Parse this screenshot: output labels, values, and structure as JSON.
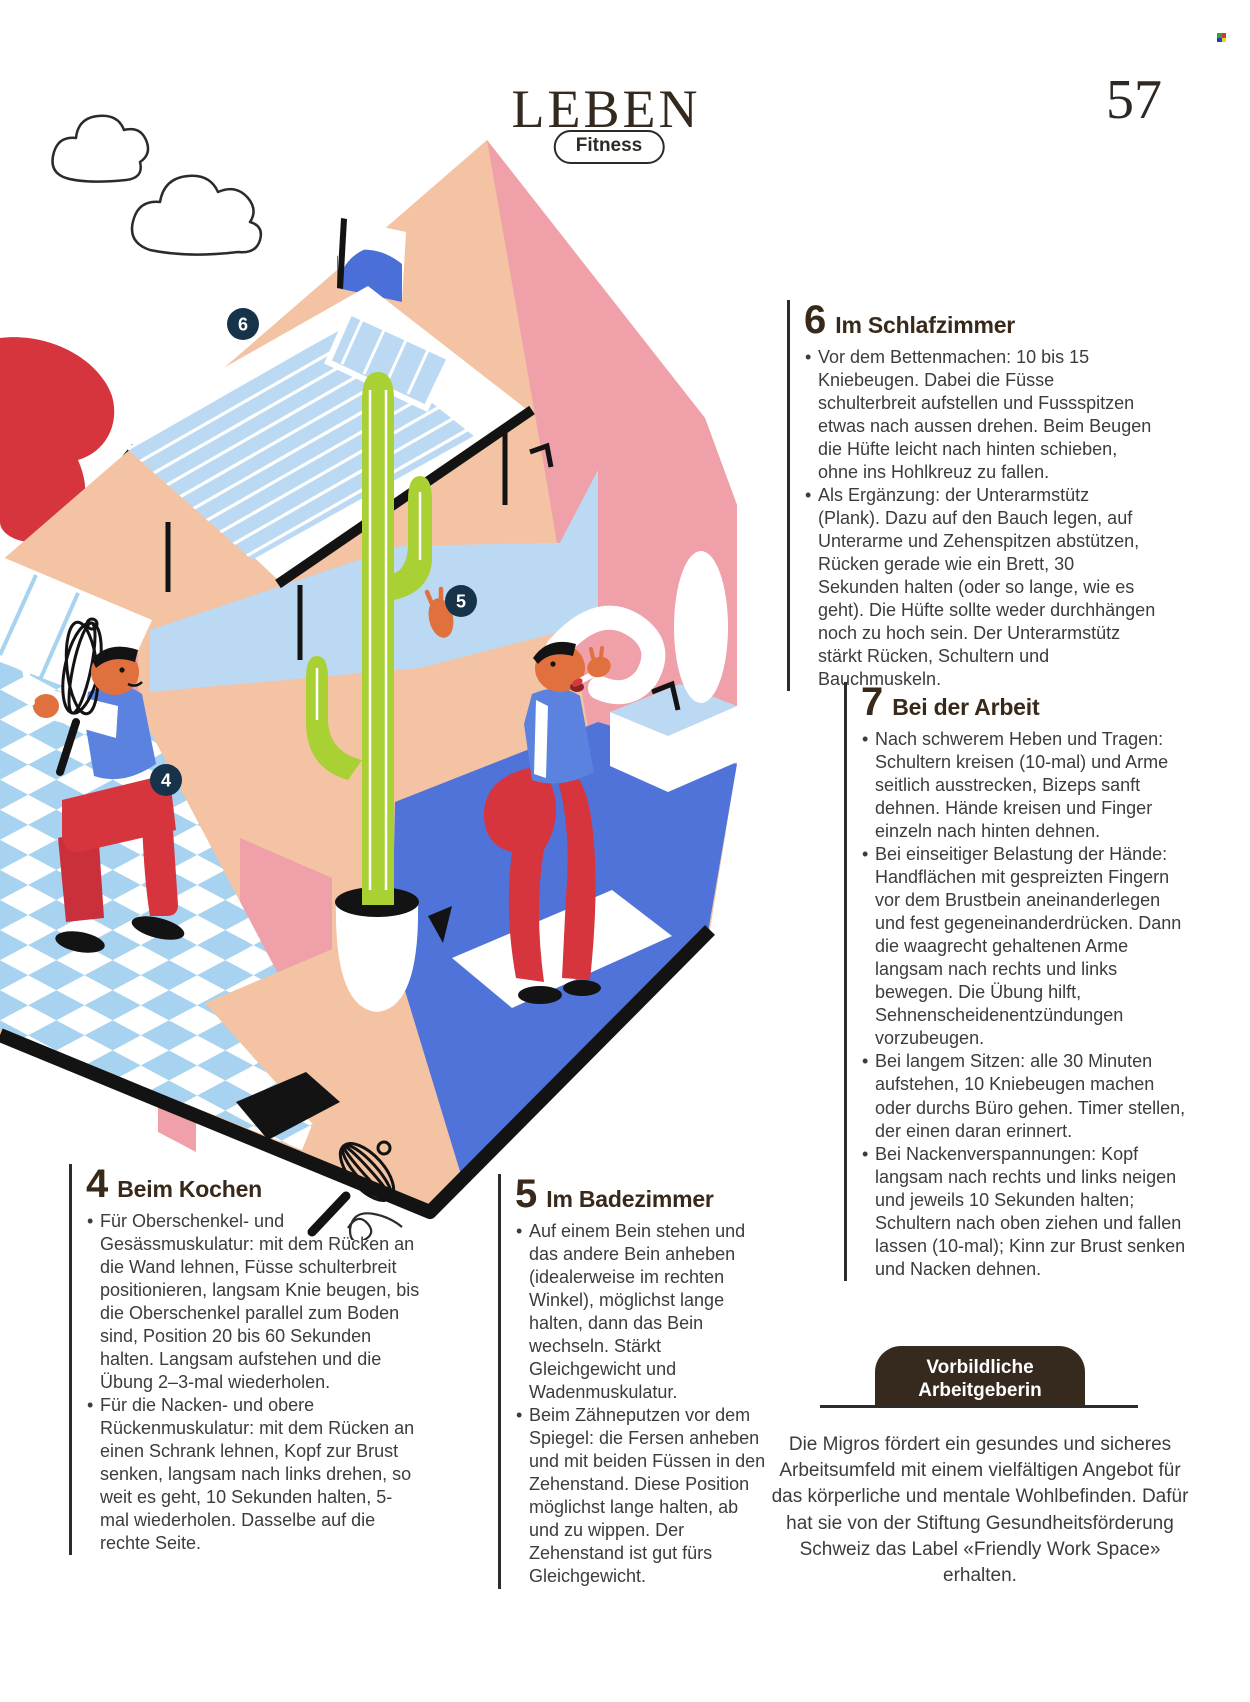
{
  "page": {
    "kicker": "LEBEN",
    "category": "Fitness",
    "page_number": "57"
  },
  "sections": [
    {
      "number": "4",
      "title": "Beim Kochen",
      "bullets": [
        "Für Oberschenkel- und Gesässmuskulatur: mit dem Rücken an die Wand lehnen, Füsse schulterbreit positionieren, langsam Knie beugen, bis die Oberschenkel parallel zum Boden sind, Position 20 bis 60 Sekunden halten. Langsam aufstehen und die Übung 2–3-mal wiederholen.",
        "Für die Nacken- und obere Rückenmuskulatur: mit dem Rücken an einen Schrank lehnen, Kopf zur Brust senken, langsam nach links drehen, so weit es geht, 10 Sekunden halten, 5-mal wiederholen. Dasselbe auf die rechte Seite."
      ]
    },
    {
      "number": "5",
      "title": "Im Badezimmer",
      "bullets": [
        "Auf einem Bein stehen und das andere Bein anheben (idealerweise im rechten Winkel), möglichst lange halten, dann das Bein wechseln. Stärkt Gleichgewicht und Wadenmuskulatur.",
        "Beim Zähneputzen vor dem Spiegel: die Fersen anheben und mit beiden Füssen in den Zehenstand. Diese Position möglichst lange halten, ab und zu wippen. Der Zehenstand ist gut fürs Gleichgewicht."
      ]
    },
    {
      "number": "6",
      "title": "Im Schlafzimmer",
      "bullets": [
        "Vor dem Bettenmachen: 10 bis 15 Kniebeugen. Dabei die Füsse schulterbreit aufstellen und Fussspitzen etwas nach aussen drehen. Beim Beugen die Hüfte leicht nach hinten schieben, ohne ins Hohlkreuz zu fallen.",
        "Als Ergänzung: der Unterarmstütz (Plank). Dazu auf den Bauch legen, auf Unterarme und Zehenspitzen abstützen, Rücken gerade wie ein Brett, 30 Sekunden halten (oder so lange, wie es geht). Die Hüfte sollte weder durchhängen noch zu hoch sein. Der Unterarmstütz stärkt Rücken, Schultern und Bauchmuskeln."
      ]
    },
    {
      "number": "7",
      "title": "Bei der Arbeit",
      "bullets": [
        "Nach schwerem Heben und Tragen: Schultern kreisen (10-mal) und Arme seitlich ausstrecken, Bizeps sanft dehnen. Hände kreisen und Finger einzeln nach hinten dehnen.",
        "Bei einseitiger Belastung der Hände: Handflächen mit gespreizten Fingern vor dem Brustbein aneinanderlegen und fest gegeneinanderdrücken. Dann die waagrecht gehaltenen Arme langsam nach rechts und links bewegen. Die Übung hilft, Sehnenscheidenentzündungen vorzubeugen.",
        "Bei langem Sitzen: alle 30 Minuten aufstehen, 10 Kniebeugen machen oder durchs Büro gehen. Timer stellen, der einen daran erinnert.",
        "Bei Nackenverspannungen: Kopf langsam nach rechts und links neigen und jeweils 10 Sekunden halten; Schultern nach oben ziehen und fallen lassen (10-mal); Kinn zur Brust senken und Nacken dehnen."
      ]
    }
  ],
  "info_box": {
    "line1": "Vorbildliche",
    "line2": "Arbeitgeberin",
    "body": "Die Migros fördert ein gesundes und sicheres Arbeitsumfeld mit einem vielfältigen Angebot für das körperliche und mentale Wohlbefinden. Dafür hat sie von der Stiftung Gesundheitsförderung Schweiz das Label «Friendly Work Space» erhalten."
  },
  "illustration": {
    "alt": "Isometric cutaway home: bedroom with striped bed, kitchen with a man doing a wall sit holding a whisk, bathroom with a man brushing teeth standing on tiptoes, tall cactus in a white pot",
    "badges": [
      {
        "label": "4"
      },
      {
        "label": "5"
      },
      {
        "label": "6"
      }
    ],
    "colors": {
      "peach": "#F3C3A3",
      "pink": "#EFA0A9",
      "light_blue": "#BBD9F3",
      "tile_blue": "#A7D2F0",
      "floor_blue": "#4F73D8",
      "cactus_green": "#A9D134",
      "red": "#D6353E",
      "skin": "#E0713F",
      "vest_blue": "#5B82DE",
      "badge_navy": "#173349"
    }
  },
  "registration_mark_colors": [
    "#2FA52F",
    "#D03A28",
    "#2738C8",
    "#E7D629"
  ]
}
